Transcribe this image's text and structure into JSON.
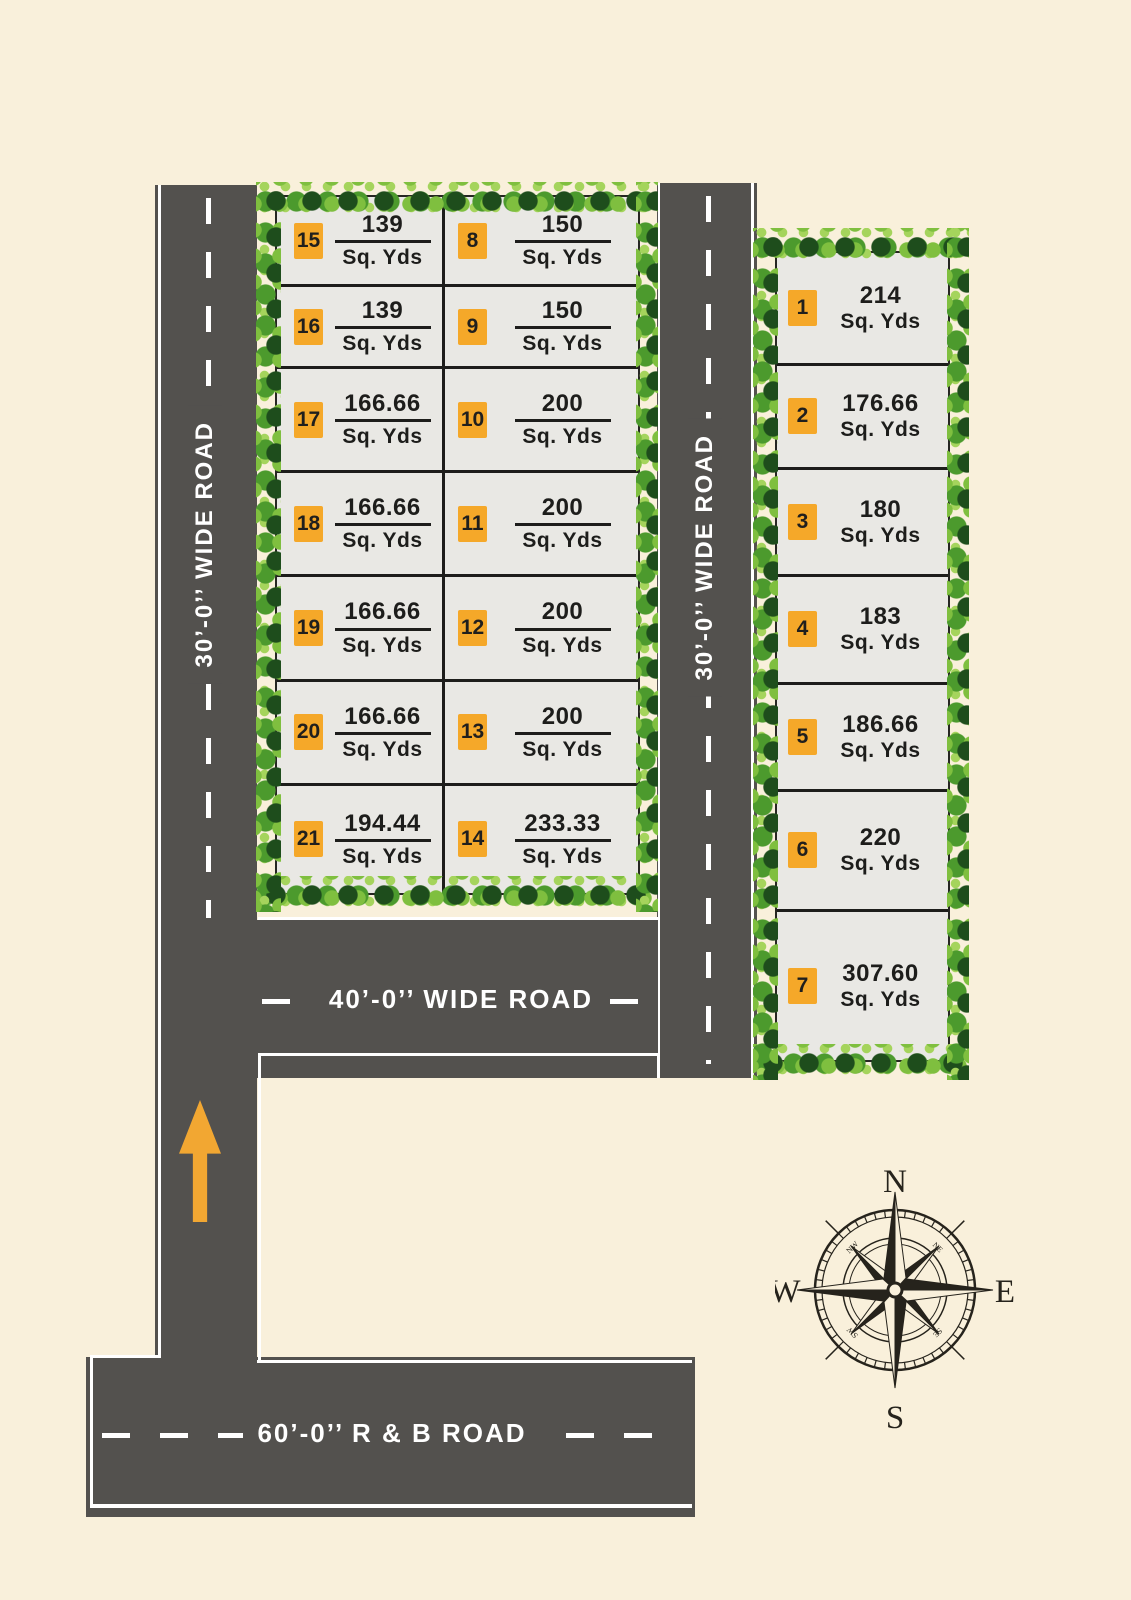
{
  "title": "residential plot layout site plan",
  "unit": "Sq. Yds",
  "roads": {
    "left_road_label": "30’-0’’ WIDE ROAD",
    "middle_road_label": "30’-0’’ WIDE ROAD",
    "forty_road_label": "40’-0’’ WIDE ROAD",
    "sixty_road_label": "60’-0’’ R & B  ROAD"
  },
  "left_block": {
    "left_column": [
      {
        "plot": "15",
        "area": "139"
      },
      {
        "plot": "16",
        "area": "139"
      },
      {
        "plot": "17",
        "area": "166.66"
      },
      {
        "plot": "18",
        "area": "166.66"
      },
      {
        "plot": "19",
        "area": "166.66"
      },
      {
        "plot": "20",
        "area": "166.66"
      },
      {
        "plot": "21",
        "area": "194.44"
      }
    ],
    "right_column": [
      {
        "plot": "8",
        "area": "150"
      },
      {
        "plot": "9",
        "area": "150"
      },
      {
        "plot": "10",
        "area": "200"
      },
      {
        "plot": "11",
        "area": "200"
      },
      {
        "plot": "12",
        "area": "200"
      },
      {
        "plot": "13",
        "area": "200"
      },
      {
        "plot": "14",
        "area": "233.33"
      }
    ]
  },
  "right_block": {
    "plots": [
      {
        "plot": "1",
        "area": "214"
      },
      {
        "plot": "2",
        "area": "176.66"
      },
      {
        "plot": "3",
        "area": "180"
      },
      {
        "plot": "4",
        "area": "183"
      },
      {
        "plot": "5",
        "area": "186.66"
      },
      {
        "plot": "6",
        "area": "220"
      },
      {
        "plot": "7",
        "area": "307.60"
      }
    ]
  },
  "compass": {
    "north": "N",
    "east": "E",
    "south": "S",
    "west": "W",
    "nw": "NW",
    "ne": "NE",
    "se": "SE",
    "sw": "SW"
  },
  "colors": {
    "background": "#F9F0DB",
    "road": "#53514E",
    "plot_fill": "#E9E8E4",
    "badge": "#F5A829",
    "arrow": "#F2A732",
    "text": "#1D1D1B",
    "tree_greens": [
      "#1E4D1C",
      "#7FBF3F",
      "#4C9A2D",
      "#A5D45C"
    ]
  }
}
